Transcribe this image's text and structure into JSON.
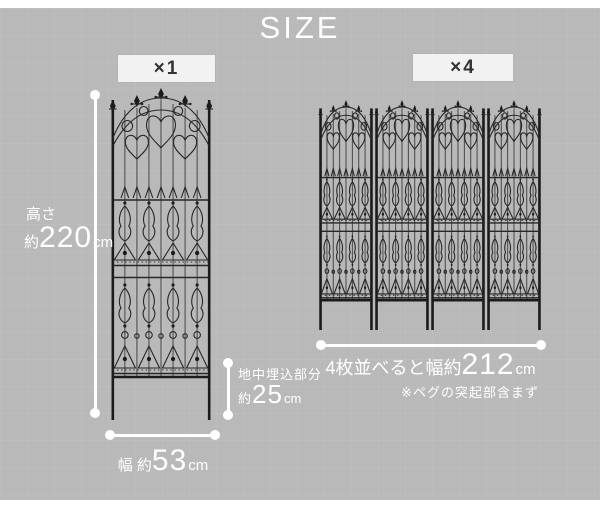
{
  "title": "SIZE",
  "colors": {
    "background_gray": "#b9b9b9",
    "measure_white": "#ffffff",
    "fence_iron": "#1b1b1b",
    "badge_bg": "#f2f2f2",
    "badge_text": "#333333"
  },
  "single": {
    "badge": "×1",
    "height": {
      "label": "高さ",
      "approx": "約",
      "value": "220",
      "unit": "cm"
    },
    "underground": {
      "label": "地中埋込部分",
      "approx": "約",
      "value": "25",
      "unit": "cm"
    },
    "width": {
      "label": "幅 約",
      "value": "53",
      "unit": "cm"
    }
  },
  "quad": {
    "badge": "×4",
    "width": {
      "label": "4枚並べると幅約",
      "value": "212",
      "unit": "cm"
    },
    "note": "※ペグの突起部含まず"
  }
}
